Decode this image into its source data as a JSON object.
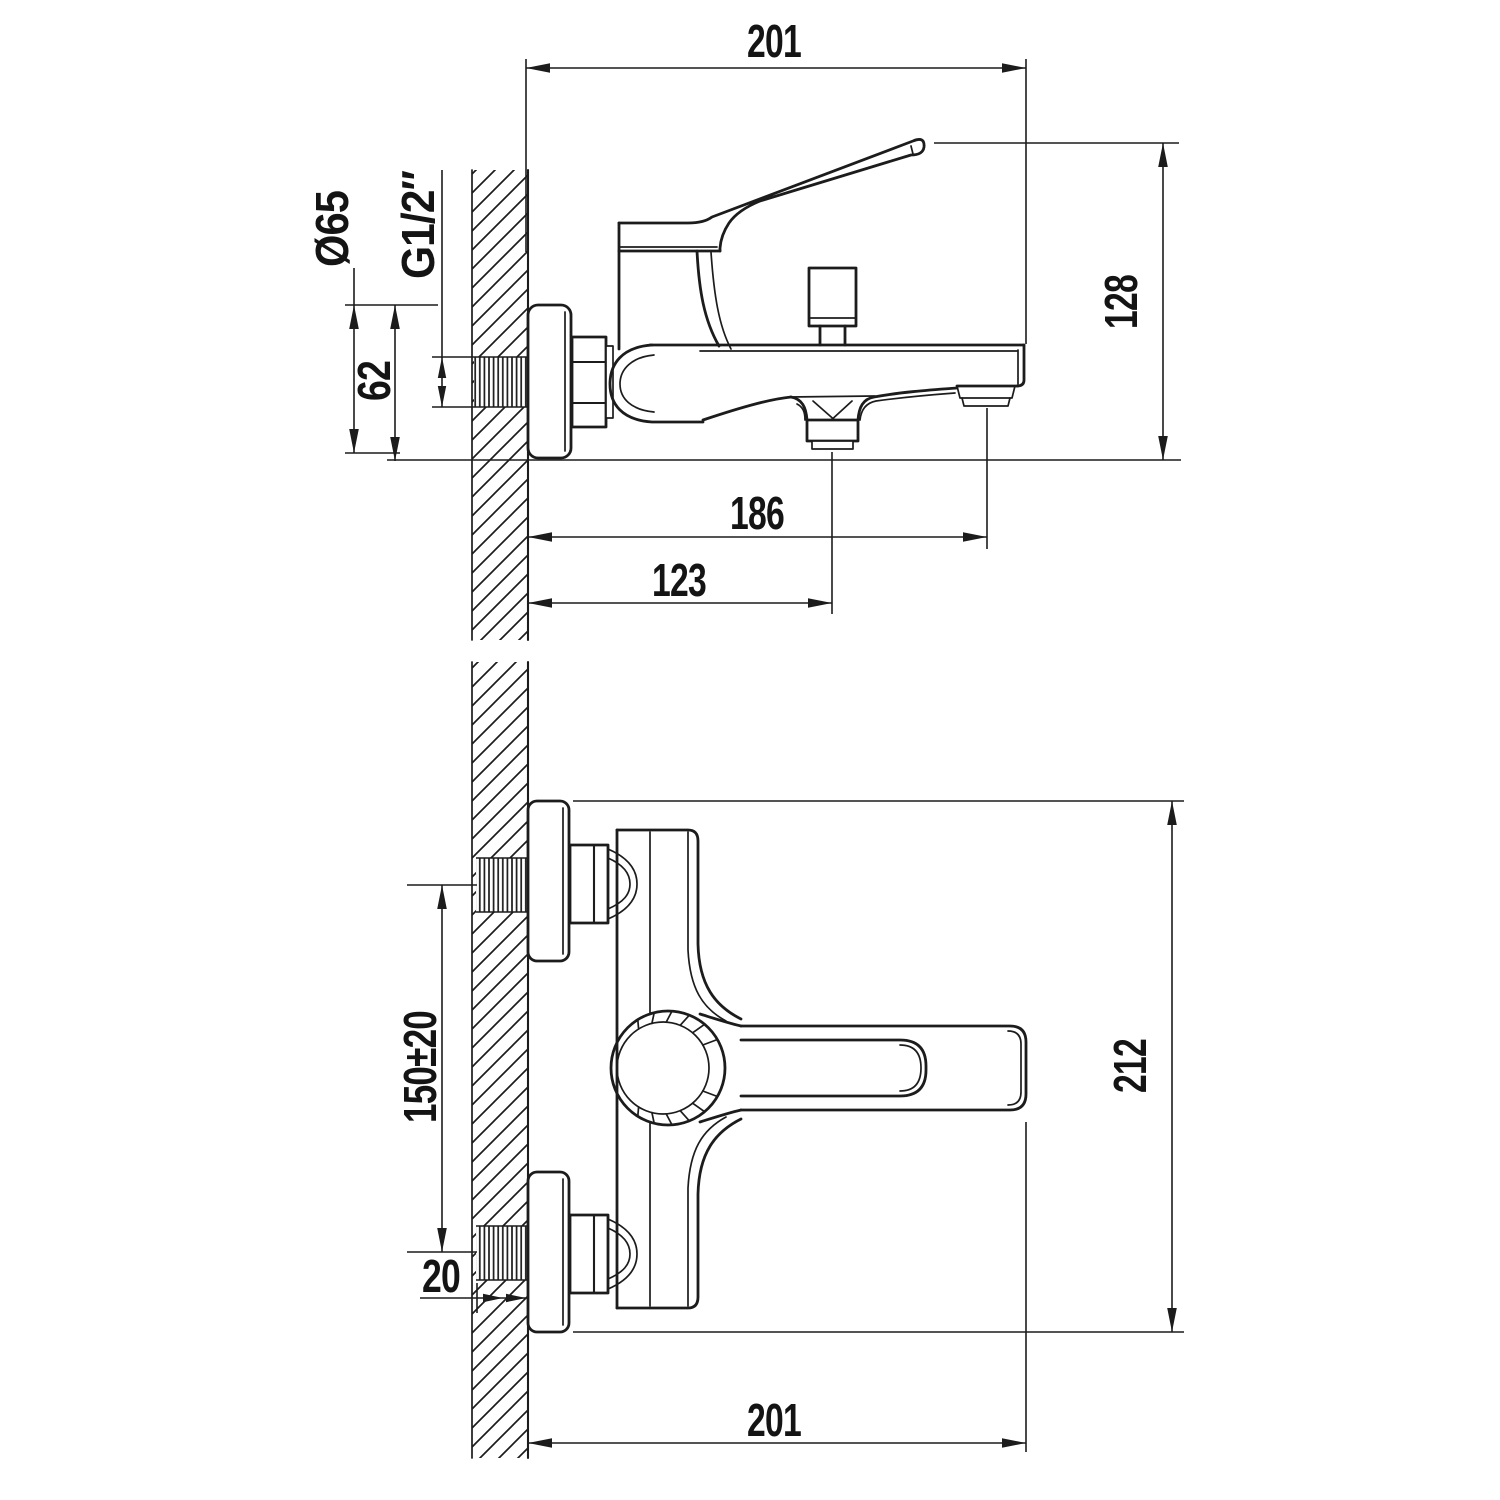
{
  "colors": {
    "line": "#1c1c1c",
    "background": "#ffffff"
  },
  "drawing": {
    "side_view": {
      "overall_depth": "201",
      "overall_height": "128",
      "escutcheon_diameter": "Ø65",
      "thread_size": "G1/2″",
      "escutcheon_height": "62",
      "spout_outlet_reach": "186",
      "shower_outlet_reach": "123"
    },
    "front_view": {
      "connection_spacing": "150±20",
      "wall_thread_length": "20",
      "overall_height": "212",
      "overall_width": "201"
    }
  }
}
